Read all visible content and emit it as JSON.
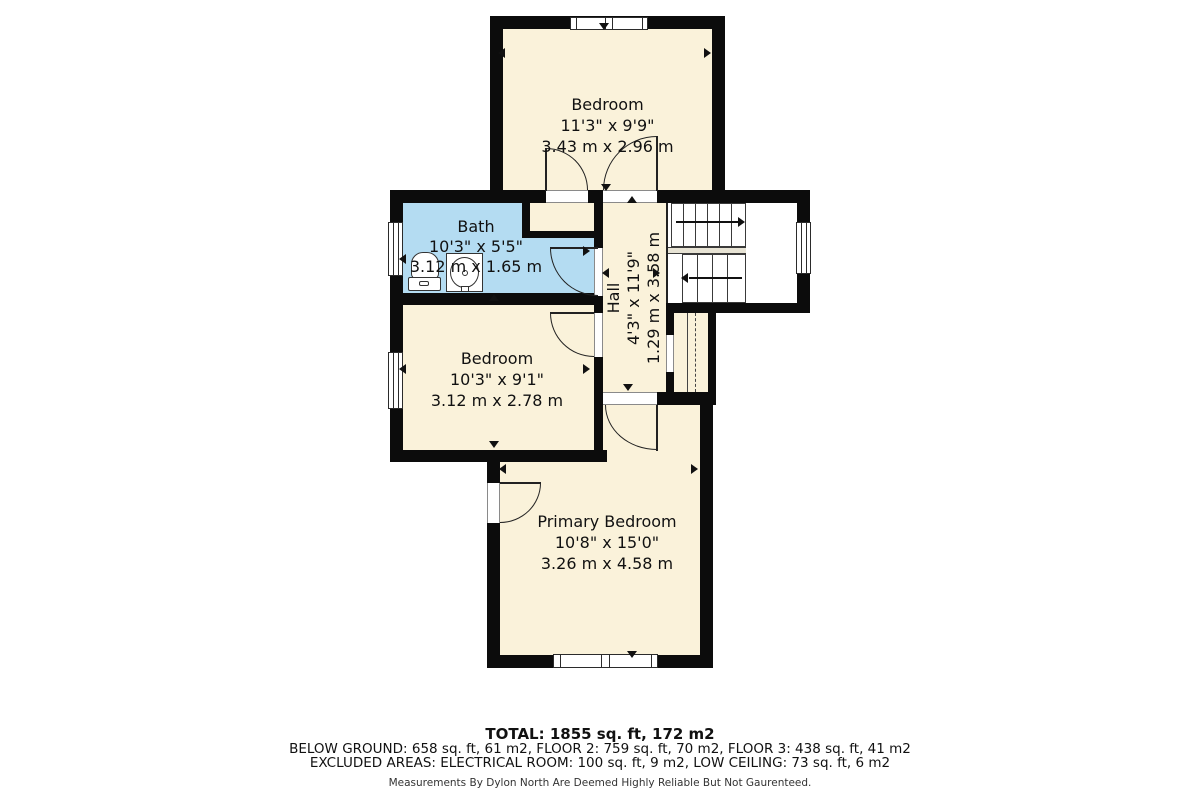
{
  "plan": {
    "rooms": {
      "bedroom_top": {
        "name": "Bedroom",
        "imperial": "11'3\" x 9'9\"",
        "metric": "3.43 m x 2.96 m"
      },
      "bath": {
        "name": "Bath",
        "imperial": "10'3\" x 5'5\"",
        "metric": "3.12 m x 1.65 m"
      },
      "bedroom_mid": {
        "name": "Bedroom",
        "imperial": "10'3\" x 9'1\"",
        "metric": "3.12 m x 2.78 m"
      },
      "hall": {
        "name": "Hall",
        "imperial": "4'3\" x 11'9\"",
        "metric": "1.29 m x 3.58 m"
      },
      "primary_bedroom": {
        "name": "Primary Bedroom",
        "imperial": "10'8\" x 15'0\"",
        "metric": "3.26 m x 4.58 m"
      }
    },
    "summary": {
      "total": "TOTAL: 1855 sq. ft, 172 m2",
      "floors": "BELOW GROUND: 658 sq. ft, 61 m2, FLOOR 2: 759 sq. ft, 70 m2, FLOOR 3: 438 sq. ft, 41 m2",
      "excluded": "EXCLUDED AREAS: ELECTRICAL ROOM: 100 sq. ft, 9 m2, LOW CEILING: 73 sq. ft, 6 m2",
      "disclaimer": "Measurements By Dylon North Are Deemed Highly Reliable But Not Gaurenteed."
    },
    "colors": {
      "wall": "#0c0c0c",
      "room_fill": "#FAF2DA",
      "bath_fill": "#B4DCF2",
      "landing_fill": "#E7E3D4"
    }
  }
}
